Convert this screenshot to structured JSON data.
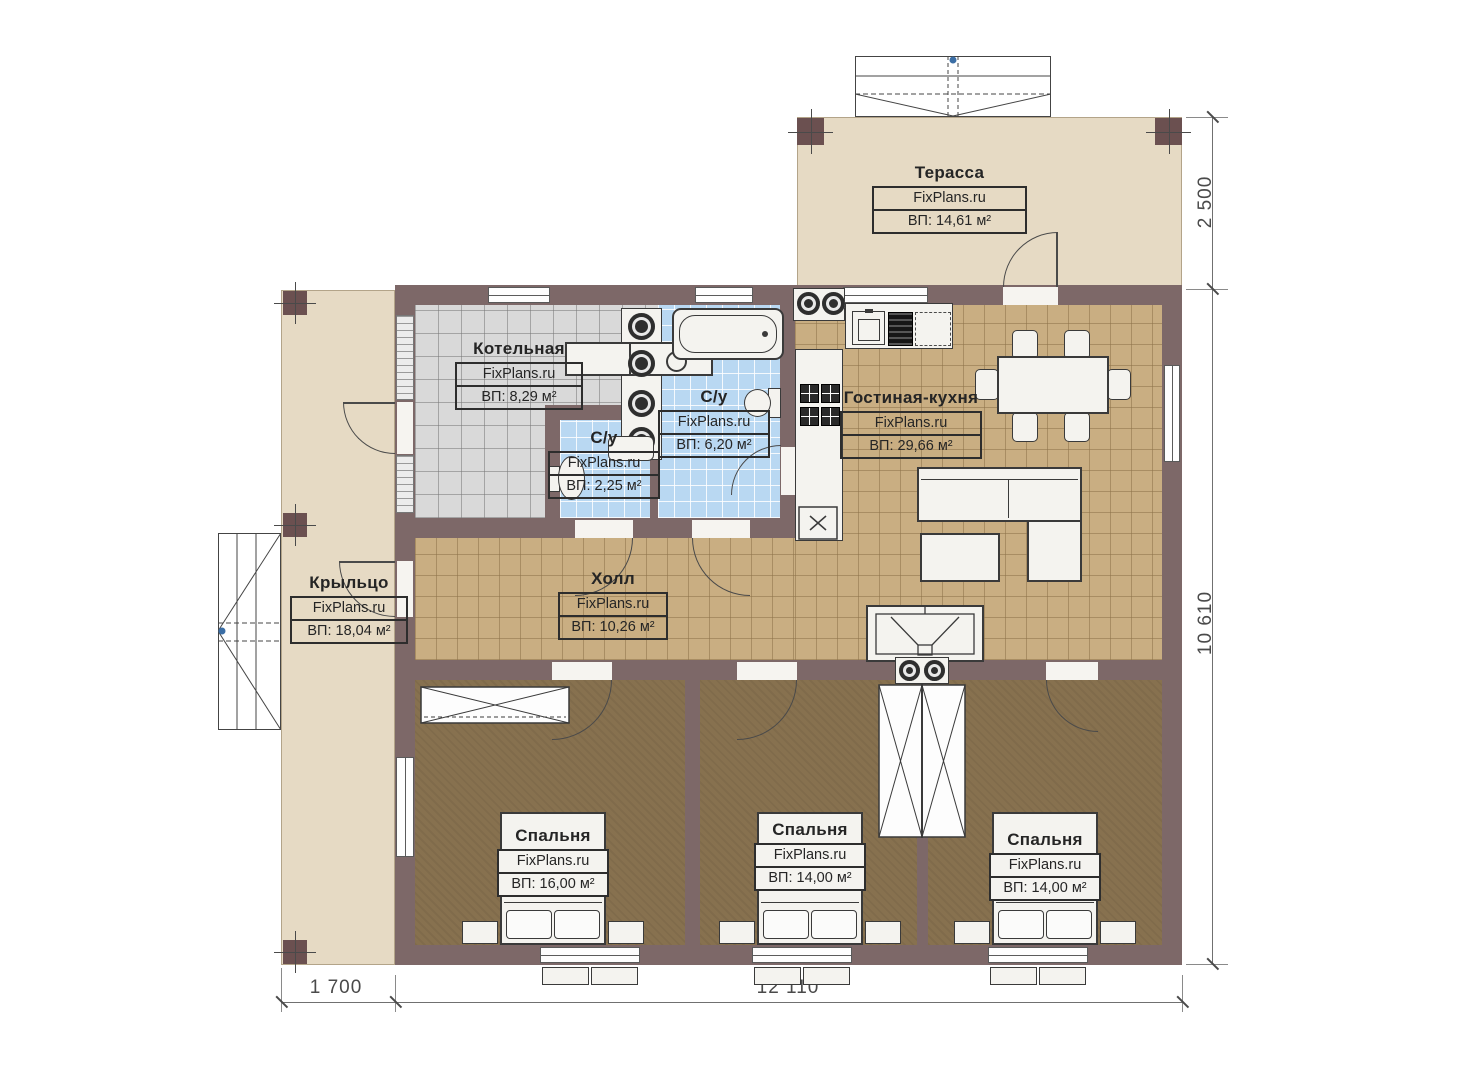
{
  "plan": {
    "brand": "FixPlans.ru",
    "type": "floor-plan"
  },
  "rooms": [
    {
      "id": "terrace",
      "name": "Терасса",
      "brand": "FixPlans.ru",
      "area": "ВП: 14,61 м²"
    },
    {
      "id": "boiler-room",
      "name": "Котельная",
      "brand": "FixPlans.ru",
      "area": "ВП: 8,29 м²"
    },
    {
      "id": "bathroom-large",
      "name": "С/у",
      "brand": "FixPlans.ru",
      "area": "ВП: 6,20 м²"
    },
    {
      "id": "bathroom-small",
      "name": "С/у",
      "brand": "FixPlans.ru",
      "area": "ВП: 2,25 м²"
    },
    {
      "id": "living-kitchen",
      "name": "Гостиная-кухня",
      "brand": "FixPlans.ru",
      "area": "ВП: 29,66 м²"
    },
    {
      "id": "porch",
      "name": "Крыльцо",
      "brand": "FixPlans.ru",
      "area": "ВП: 18,04 м²"
    },
    {
      "id": "hall",
      "name": "Холл",
      "brand": "FixPlans.ru",
      "area": "ВП: 10,26 м²"
    },
    {
      "id": "bedroom-1",
      "name": "Спальня",
      "brand": "FixPlans.ru",
      "area": "ВП: 16,00 м²"
    },
    {
      "id": "bedroom-2",
      "name": "Спальня",
      "brand": "FixPlans.ru",
      "area": "ВП: 14,00 м²"
    },
    {
      "id": "bedroom-3",
      "name": "Спальня",
      "brand": "FixPlans.ru",
      "area": "ВП: 14,00 м²"
    }
  ],
  "dimensions": {
    "terrace_depth": "2 500",
    "house_depth": "10 610",
    "porch_width": "1 700",
    "house_width": "12 110"
  },
  "colors": {
    "wall": "#7d6868",
    "post": "#6b5050",
    "terrace_floor": "#e6dac4",
    "tile_tan": "#c9ae82",
    "tile_gray": "#d9d9d9",
    "tile_blue": "#b9d8f2",
    "bedroom_floor": "#87714f"
  }
}
